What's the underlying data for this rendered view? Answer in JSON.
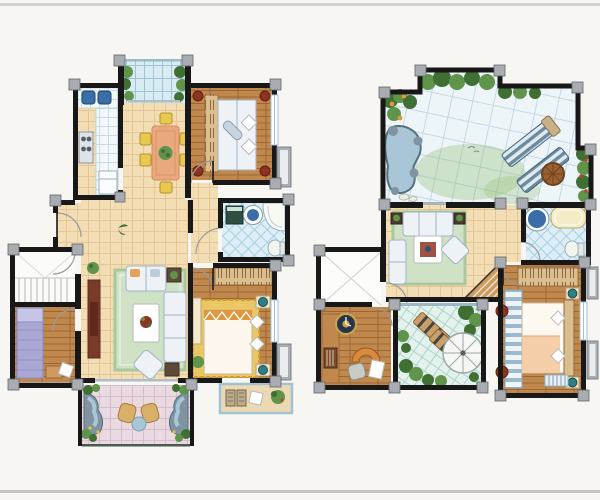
{
  "scene": {
    "kind": "hand-painted watercolor real-estate floor plan illustration",
    "layout": "two storey plans side by side on a white card with thin gray rule at top and bottom",
    "floors": [
      {
        "name": "lower-floor-plan",
        "position": "left",
        "rooms": [
          "north-balcony-with-plants",
          "kitchen",
          "dining-room",
          "bedroom-2",
          "bathroom",
          "entry-hall",
          "stair-hall",
          "bedroom-3",
          "living-room",
          "master-bedroom",
          "garden-balcony",
          "master-balcony"
        ],
        "furniture": [
          "dining-table-with-six-yellow-chairs",
          "kitchen-counter-sink-stove-fridge",
          "double-bed-with-wardrobe",
          "corner-bathtub-basin-washer-toilet",
          "green-rug-sofa-set-tv-console",
          "bed-on-yellow-rug",
          "purple-single-bed",
          "staircase",
          "rock-pond-water-features-wicker-chairs"
        ]
      },
      {
        "name": "upper-floor-plan",
        "position": "right",
        "rooms": [
          "roof-garden-terrace",
          "family-room",
          "bathroom",
          "hallway",
          "stair-void",
          "study",
          "sun-room-conservatory",
          "master-bedroom"
        ],
        "furniture": [
          "rock-pond",
          "two-striped-deck-loungers",
          "round-wood-table",
          "green-rug-sofa-set",
          "staircase-down",
          "round-basin-bathtub-toilet",
          "desk-bookshelf-wall-clock-arch-hearth",
          "two-garden-loungers-white-parasol",
          "double-bed-striped-wardrobe-hatched-dresser"
        ]
      }
    ]
  },
  "palette": {
    "bg": "#f7f6f3",
    "frame-line": "#d2d1ce",
    "frame-line2": "#c6c5c2",
    "wall": "#181818",
    "column": "#a9adb1",
    "door-arc": "#9a9a9a",
    "beige": "#f3ddb5",
    "beige-line": "#e4c794",
    "wood": "#c1884e",
    "wood-line": "#9b6835",
    "wood2": "#cd9a60",
    "counter": "#f3f8fa",
    "counter-line": "#c6dde8",
    "bluetile": "#ddeef6",
    "bluetile-line": "#a9cfe2",
    "terrace": "#eef5f9",
    "terrace-line": "#c2d9e6",
    "pink": "#ead9e1",
    "pink-line": "#d5bdcd",
    "glass": "#d9ecf3",
    "glass-line": "#9fc3d4",
    "glass2": "#e4f2ee",
    "glass2-line": "#aed4c6",
    "rug-green": "#cfe2c6",
    "rug-green-line": "#a9c89d",
    "rug-yellow": "#e9c763",
    "rug-yellow-line": "#cfa034",
    "sofa": "#eef2f6",
    "sofa-line": "#9fb4c8",
    "cream": "#f4e8cd",
    "dresser": "#dcbd8d",
    "dresser-line": "#8a6a42",
    "plant-dark": "#3f6f33",
    "plant-mid": "#5f944a",
    "plant-light": "#93bd72",
    "water": "#a9c6d6",
    "rock": "#7f93a1",
    "rock-dark": "#54707e",
    "accent-red": "#8e3322",
    "accent-teal": "#2e7f86",
    "accent-orange": "#e0973c",
    "bed-purple": "#a9a8d4",
    "bed-purple-line": "#8b8ac0",
    "table-salmon": "#e9a97e",
    "table-salmon-line": "#d68d5b",
    "chair-yellow": "#e7c94f",
    "chair-yellow-line": "#b2922b",
    "lounger": "#6c8ba0",
    "lounger-stripe": "#e0eaf1",
    "umbrella": "#f5f7f4",
    "umbrella-line": "#9aa8a8",
    "stairs-line": "#b5b5b2",
    "toilet-white": "#f2f4ee",
    "tub-cream": "#f4ecc6",
    "basin-blue": "#3a6ea8",
    "washer-green": "#2e4f42",
    "tv-brown": "#7a3a28",
    "tv-dark": "#5d2a1c",
    "peach": "#f2c9a0",
    "balcony-tan": "#ecd9b4",
    "stripe-blue": "#9cb8cc"
  }
}
